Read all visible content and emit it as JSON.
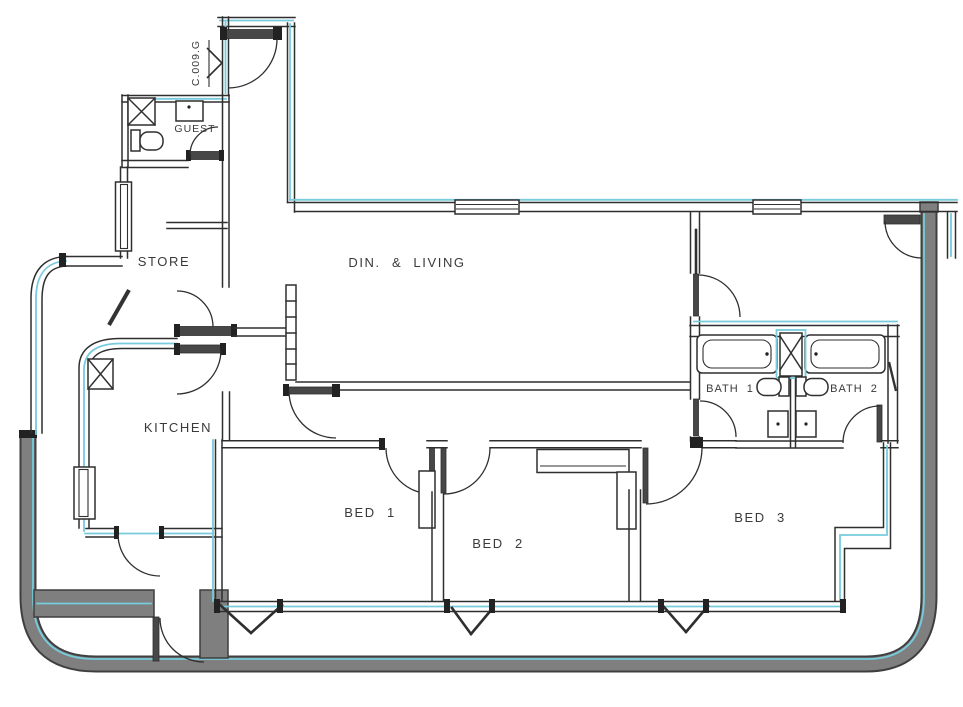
{
  "plan": {
    "title": "apartment floor plan",
    "rooms": {
      "dining_living": "DIN. & LIVING",
      "kitchen": "KITCHEN",
      "store": "STORE",
      "guest": "GUEST",
      "bath1": "BATH 1",
      "bath2": "BATH 2",
      "bed1": "BED 1",
      "bed2": "BED 2",
      "bed3": "BED 3"
    },
    "entrance": {
      "code": "C.009.G"
    },
    "icons": {
      "entrance_arrow": "right-arrow-marker",
      "shaft_boxes": "x-crossed-shaft-box",
      "fixtures": [
        "bathtub",
        "toilet",
        "sink",
        "wardrobe",
        "window",
        "door-swing"
      ]
    },
    "colors": {
      "accent_cyan": "#76cbdc",
      "wall_line": "#2f2f2f",
      "leaf_dark": "#474747",
      "band_gray": "#7f7f7f",
      "band_edge": "#3f3f3f",
      "text": "#3a3a3a",
      "background": "#ffffff"
    }
  }
}
